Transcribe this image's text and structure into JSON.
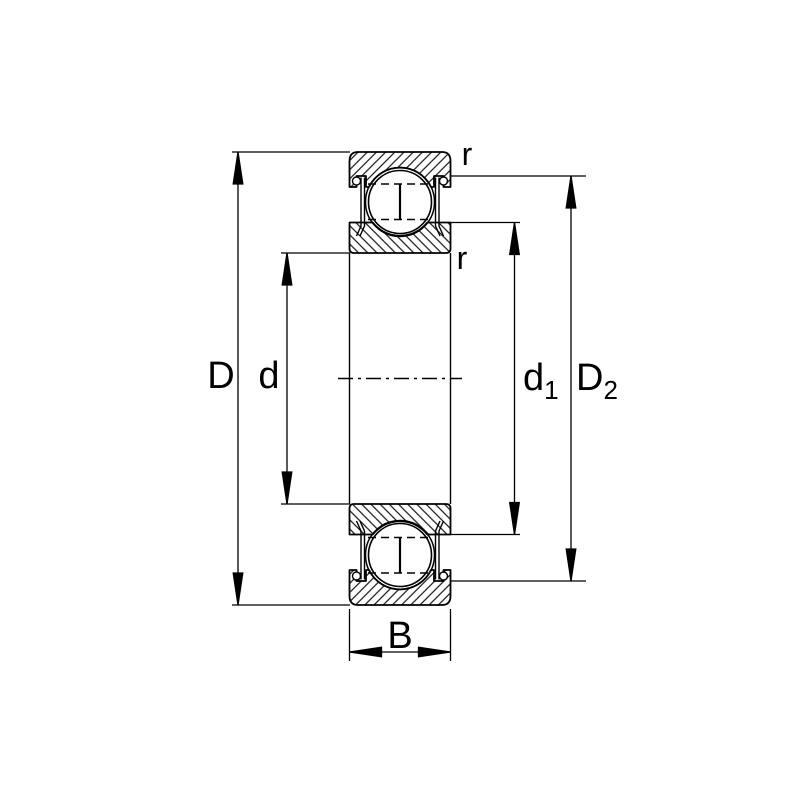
{
  "diagram": {
    "title": "deep-groove-ball-bearing-cross-section-with-shields",
    "colors": {
      "line": "#000000",
      "background": "#ffffff"
    },
    "labels": {
      "outer_diameter": "D",
      "bore_diameter": "d",
      "shoulder_diameter_base": "d",
      "shoulder_diameter_sub": "1",
      "recess_diameter_base": "D",
      "recess_diameter_sub": "2",
      "width": "B",
      "radius_outer": "r",
      "radius_inner": "r"
    }
  }
}
